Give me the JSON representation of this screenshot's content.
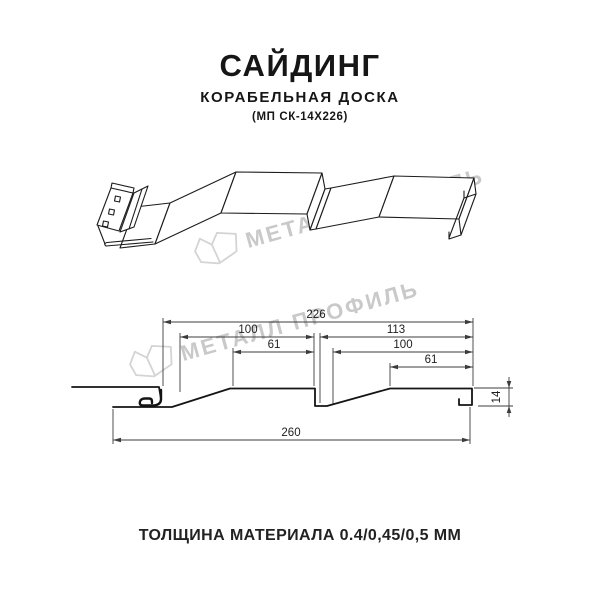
{
  "title": {
    "main": "САЙДИНГ",
    "subtitle": "КОРАБЕЛЬНАЯ ДОСКА",
    "code": "(МП СК-14Х226)"
  },
  "footer": {
    "thickness": "ТОЛЩИНА МАТЕРИАЛА 0.4/0,45/0,5 ММ"
  },
  "watermark": {
    "brand": "МЕТАЛЛ ПРОФИЛЬ"
  },
  "section": {
    "dimensions": {
      "overall_width_top": "226",
      "left_panel_width": "100",
      "right_panel_width": "113",
      "left_face_width": "61",
      "right_panel_inner_width": "100",
      "right_face_width": "61",
      "overall_width_bottom": "260",
      "profile_height": "14"
    }
  },
  "colors": {
    "line": "#1c1c1c",
    "dimension": "#3c3c3c",
    "watermark": "#c9c9c9"
  }
}
